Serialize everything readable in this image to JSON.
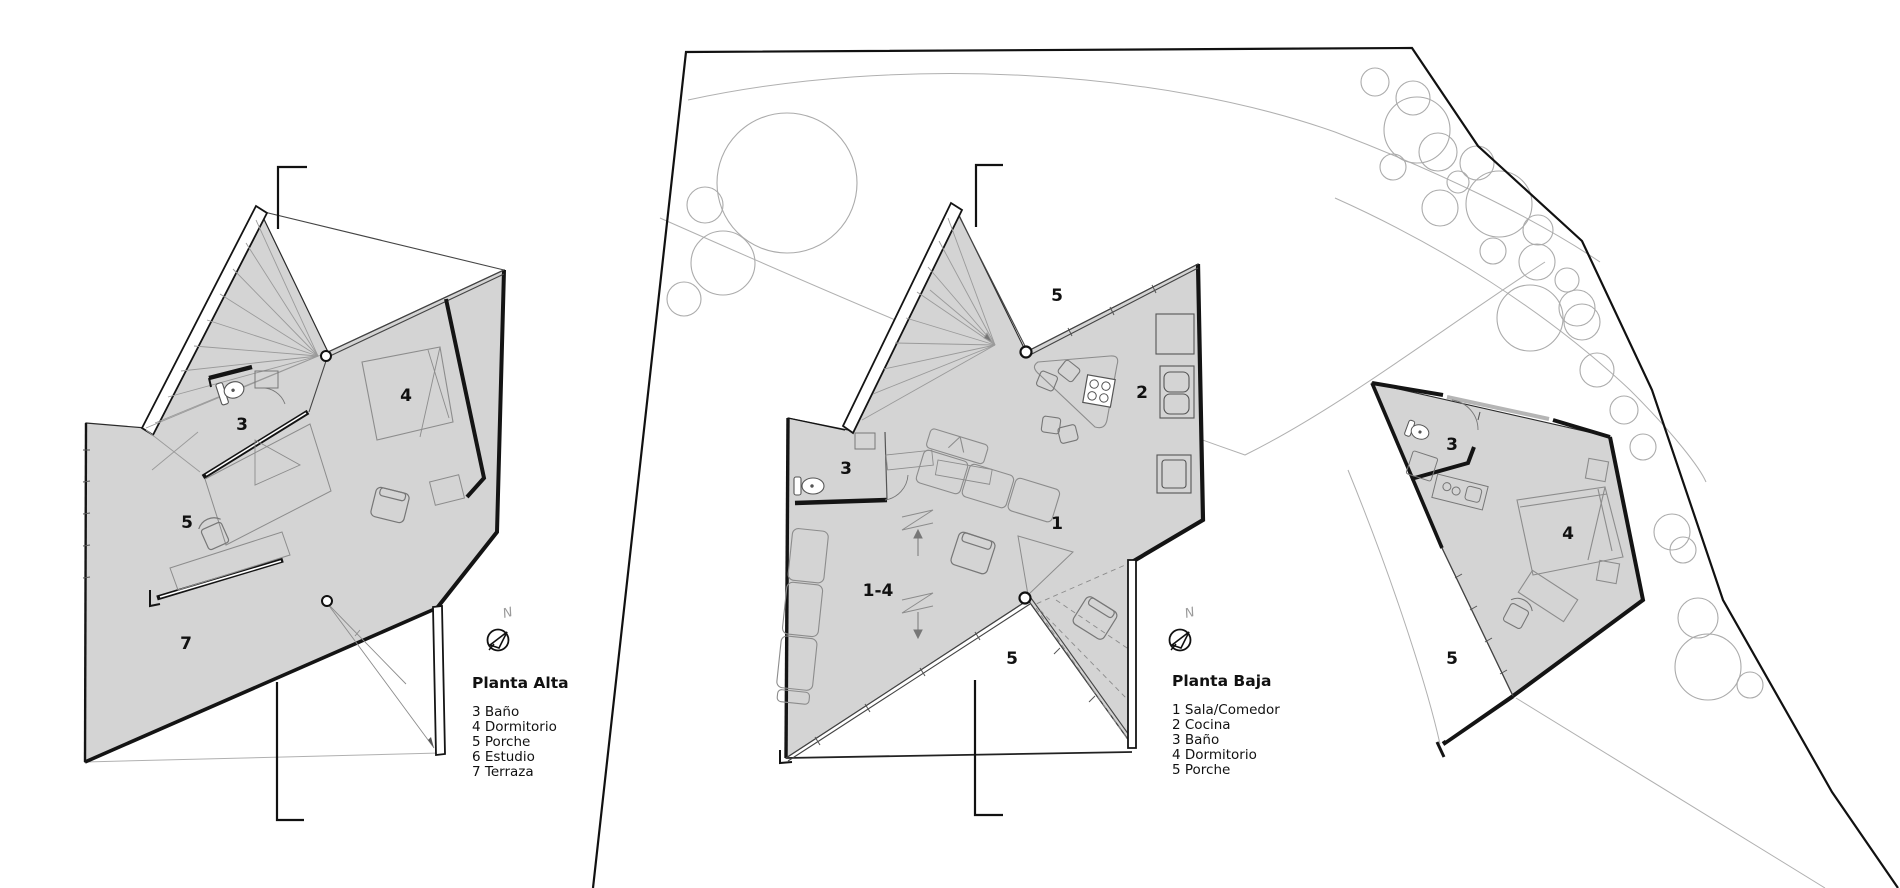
{
  "document": {
    "type": "architectural-plan-sheet"
  },
  "colors": {
    "plan_fill": "#d4d4d4",
    "wall": "#141414",
    "thin_line": "#8c8c8c",
    "tree_line": "#aaaaaa",
    "site_boundary": "#111111"
  },
  "north_arrow": {
    "label": "N"
  },
  "legend_alta": {
    "title": "Planta Alta",
    "items": [
      "3 Baño",
      "4 Dormitorio",
      "5 Porche",
      "6 Estudio",
      "7 Terraza"
    ]
  },
  "legend_baja": {
    "title": "Planta Baja",
    "items": [
      "1 Sala/Comedor",
      "2 Cocina",
      "3 Baño",
      "4 Dormitorio",
      "5 Porche"
    ]
  },
  "room_labels": {
    "alta": {
      "bath": "3",
      "bedroom": "4",
      "porch": "5",
      "terrace": "7"
    },
    "baja": {
      "porch_top": "5",
      "kitchen": "2",
      "bath": "3",
      "living": "1",
      "living_bed": "1-4",
      "porch_bottom": "5"
    },
    "guest": {
      "bath": "3",
      "bedroom": "4",
      "porch": "5"
    }
  }
}
